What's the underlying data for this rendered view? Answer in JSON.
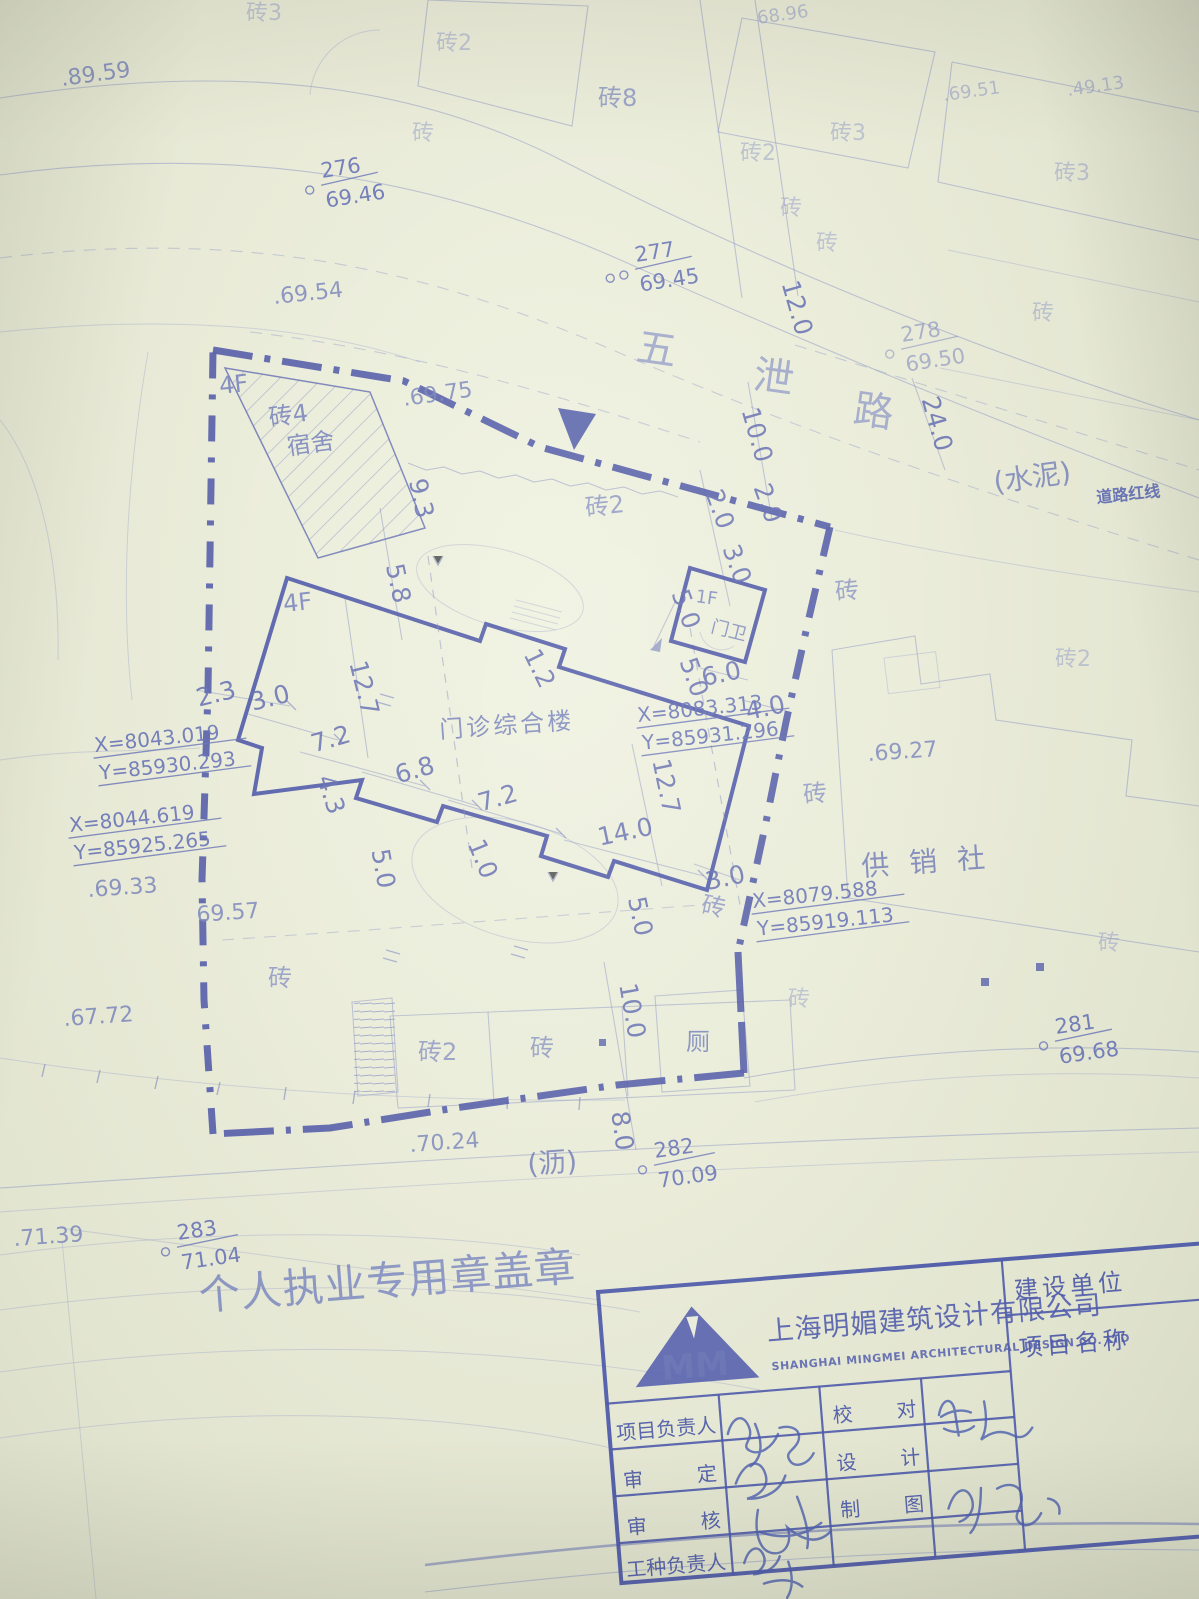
{
  "map": {
    "road": [
      "五",
      "泄",
      "路"
    ],
    "stamp": "个人执业专用章盖章",
    "labels": {
      "main_building": "门诊综合楼",
      "main_floors": "4F",
      "dorm_floors": "4F",
      "dorm_material": "砖4",
      "dorm_use": "宿舍",
      "gate_floors": "1F",
      "gate_label": "门卫",
      "coop": "供销社",
      "toilet": "厕",
      "cement": "(水泥)",
      "redline": "道路红线",
      "asphalt": "(沥)"
    },
    "mats": [
      "砖3",
      "砖2",
      "砖8",
      "砖",
      "砖2",
      "砖3",
      "砖3",
      "砖",
      "砖",
      "砖",
      "砖2",
      "砖",
      "砖2",
      "砖",
      "砖",
      "砖",
      "砖",
      "砖2",
      "砖",
      "砖"
    ],
    "elevations": [
      ".89.59",
      ".69.54",
      ".69.75",
      ".69.33",
      "69.57",
      ".67.72",
      ".70.24",
      ".71.39",
      ".69.27",
      ".69.51",
      ".49.13",
      "68.96"
    ],
    "points": [
      {
        "n": "276",
        "e": "69.46"
      },
      {
        "n": "277",
        "e": "69.45"
      },
      {
        "n": "278",
        "e": "69.50"
      },
      {
        "n": "281",
        "e": "69.68"
      },
      {
        "n": "282",
        "e": "70.09"
      },
      {
        "n": "283",
        "e": "71.04"
      }
    ],
    "coords": [
      {
        "x": "X=8043.019",
        "y": "Y=85930.293"
      },
      {
        "x": "X=8044.619",
        "y": "Y=85925.265"
      },
      {
        "x": "X=8083.313",
        "y": "Y=85931.296"
      },
      {
        "x": "X=8079.588",
        "y": "Y=85919.113"
      }
    ],
    "dims": [
      "2.3",
      "3.0",
      "7.2",
      "12.7",
      "5.8",
      "9.3",
      "4.3",
      "6.8",
      "7.2",
      "1.2",
      "1.0",
      "5.0",
      "5.0",
      "5.0",
      "6.0",
      "4.0",
      "12.7",
      "14.0",
      "3.0",
      "5.0",
      "10.0",
      "8.0",
      "2.0",
      "2.0",
      "3.0",
      "10.0",
      "12.0",
      "24.0"
    ]
  },
  "title_block": {
    "company_cn": "上海明媚建筑设计有限公司",
    "company_en": "SHANGHAI MINGMEI ARCHITECTURAL DESIGN CO. LTD",
    "logo": "MM",
    "owner_label": "建设单位",
    "project_label": "项目名称",
    "rows": {
      "pm": "项目负责人",
      "check_a": "校",
      "check_b": "对",
      "approve_a": "审",
      "approve_b": "定",
      "design_a": "设",
      "design_b": "计",
      "review_a": "审",
      "review_b": "核",
      "draft_a": "制",
      "draft_b": "图",
      "trade": "工种负责人"
    }
  }
}
